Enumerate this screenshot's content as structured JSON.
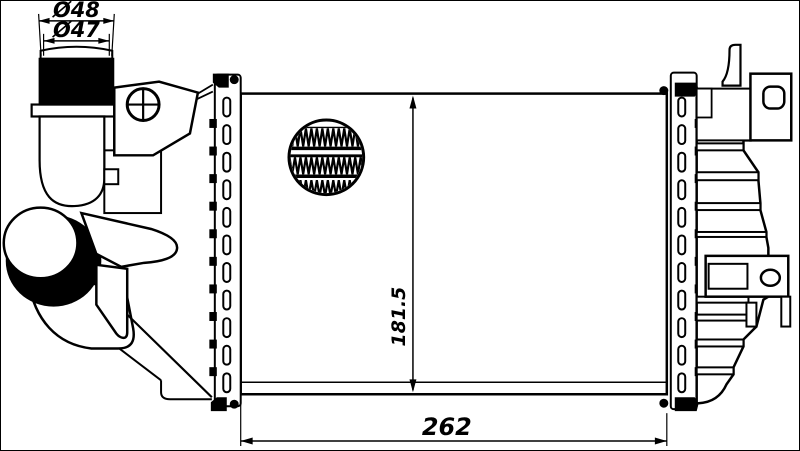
{
  "drawing": {
    "dim_pipe_outer": "Ø48",
    "dim_pipe_inner": "Ø47",
    "dim_height": "181.5",
    "dim_width": "262",
    "line_color": "#000000",
    "background_color": "#ffffff"
  }
}
